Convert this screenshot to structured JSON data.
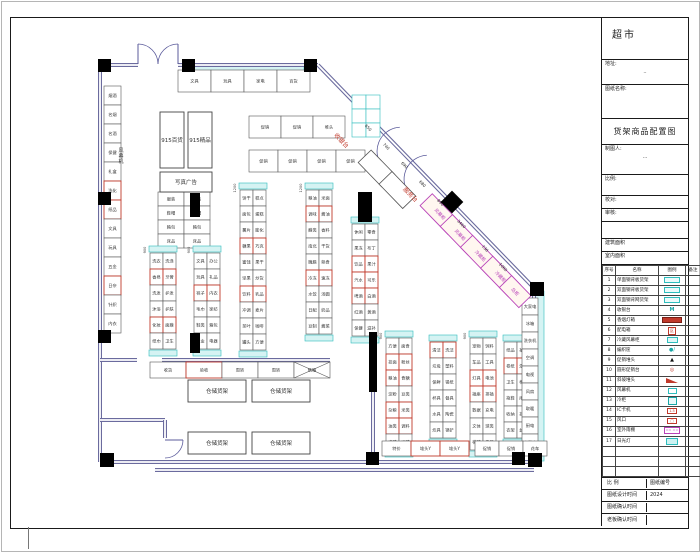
{
  "title_block": {
    "store_name": "超市",
    "address_label": "地址:",
    "address_value": "··",
    "drawing_name_label": "图纸名称:",
    "drawing_title": "货架商品配置图",
    "drafter_label": "制图人:",
    "drafter_value": "···",
    "scale_label": "比例:",
    "check_label": "校对:",
    "audit_label": "审核:",
    "area1_label": "建筑面积",
    "area2_label": "室内面积",
    "legend": {
      "headers": [
        "序号",
        "名称",
        "图例",
        "备注"
      ],
      "rows": [
        {
          "no": "1",
          "name": "单面钢背板货架",
          "sym": "cyanrect"
        },
        {
          "no": "2",
          "name": "双面钢背板货架",
          "sym": "cyanrect"
        },
        {
          "no": "3",
          "name": "双面钢背网货架",
          "sym": "cyanrect"
        },
        {
          "no": "4",
          "name": "收银台",
          "sym": "tealM",
          "text": "M"
        },
        {
          "no": "5",
          "name": "香烟灯箱",
          "sym": "redbar"
        },
        {
          "no": "6",
          "name": "配电箱",
          "sym": "redbox",
          "text": "区"
        },
        {
          "no": "7",
          "name": "冷藏风幕柜",
          "sym": "tealsm"
        },
        {
          "no": "8",
          "name": "编织筐",
          "sym": "dot",
          "text": "●/"
        },
        {
          "no": "9",
          "name": "促销堆头",
          "sym": "tri",
          "text": "▲"
        },
        {
          "no": "10",
          "name": "圆形促销台",
          "sym": "circ",
          "text": "◎"
        },
        {
          "no": "11",
          "name": "斜坡堆头",
          "sym": "wedge"
        },
        {
          "no": "12",
          "name": "风幕机",
          "sym": "cyansm"
        },
        {
          "no": "13",
          "name": "冷柜",
          "sym": "tealbox"
        },
        {
          "no": "14",
          "name": "IC卡机",
          "sym": "redsm",
          "text": "1.5"
        },
        {
          "no": "15",
          "name": "风口",
          "sym": "redsm",
          "text": "□"
        },
        {
          "no": "16",
          "name": "室外雨棚",
          "sym": "magbox",
          "text": "== =="
        },
        {
          "no": "17",
          "name": "日光灯",
          "sym": "cyanbox"
        },
        {
          "no": "",
          "name": "",
          "sym": ""
        },
        {
          "no": "",
          "name": "",
          "sym": ""
        },
        {
          "no": "",
          "name": "",
          "sym": ""
        }
      ]
    },
    "bottom_rows": [
      {
        "label": "比  例",
        "value_label": "图纸编号",
        "value": ""
      },
      {
        "label": "图纸设计时间",
        "value": "2024"
      },
      {
        "label": "图纸确认时间",
        "value": ""
      },
      {
        "label": "老板确认时间",
        "value": ""
      }
    ]
  },
  "plan": {
    "colors": {
      "wall": "#6b6b9e",
      "cyan": "#2fbdbd",
      "cyan_fill": "#d5f3f3",
      "red": "#c0392b",
      "magenta": "#b944b9",
      "ink": "#333333"
    },
    "walls": [
      {
        "pts": [
          [
            100,
            65
          ],
          [
            138,
            65
          ]
        ]
      },
      {
        "pts": [
          [
            178,
            65
          ],
          [
            318,
            65
          ]
        ]
      },
      {
        "pts": [
          [
            100,
            65
          ],
          [
            100,
            462
          ]
        ]
      },
      {
        "pts": [
          [
            318,
            65
          ],
          [
            534,
            288
          ]
        ]
      },
      {
        "pts": [
          [
            534,
            288
          ],
          [
            534,
            462
          ]
        ]
      },
      {
        "pts": [
          [
            100,
            462
          ],
          [
            534,
            462
          ]
        ]
      },
      {
        "pts": [
          [
            155,
            470
          ],
          [
            534,
            470
          ]
        ]
      },
      {
        "pts": [
          [
            100,
            360
          ],
          [
            137,
            360
          ]
        ]
      },
      {
        "pts": [
          [
            162,
            360
          ],
          [
            330,
            360
          ]
        ]
      },
      {
        "pts": [
          [
            373,
            330
          ],
          [
            373,
            462
          ]
        ]
      },
      {
        "pts": [
          [
            100,
            420
          ],
          [
            165,
            420
          ]
        ]
      },
      {
        "pts": [
          [
            165,
            420
          ],
          [
            165,
            438
          ]
        ]
      }
    ],
    "cyan_bands": [
      {
        "x": 184,
        "y": 66,
        "w": 120,
        "h": 8
      },
      {
        "x": 535,
        "y": 291,
        "w": 9,
        "h": 170
      }
    ],
    "columns": [
      {
        "x": 98,
        "y": 59,
        "s": 13
      },
      {
        "x": 182,
        "y": 59,
        "s": 13
      },
      {
        "x": 304,
        "y": 59,
        "s": 13
      },
      {
        "x": 98,
        "y": 192,
        "s": 13
      },
      {
        "x": 98,
        "y": 330,
        "s": 13
      },
      {
        "x": 100,
        "y": 453,
        "s": 14
      },
      {
        "x": 366,
        "y": 452,
        "s": 13
      },
      {
        "x": 512,
        "y": 452,
        "s": 13
      },
      {
        "x": 530,
        "y": 282,
        "s": 14
      },
      {
        "x": 528,
        "y": 453,
        "s": 14
      },
      {
        "x": 190,
        "y": 193,
        "s": 10,
        "h": 24
      },
      {
        "x": 190,
        "y": 333,
        "s": 10,
        "h": 20
      },
      {
        "x": 358,
        "y": 192,
        "s": 14,
        "h": 30
      },
      {
        "x": 369,
        "y": 332,
        "s": 8,
        "h": 60
      },
      {
        "x": 452,
        "y": 202,
        "s": 16,
        "shape": "diamond"
      }
    ],
    "doors": [
      {
        "hx": 138,
        "hy": 64,
        "r": 20,
        "dir": "up-right"
      },
      {
        "hx": 178,
        "hy": 64,
        "r": 20,
        "dir": "up-left"
      },
      {
        "hx": 401,
        "hy": 151,
        "r": 24,
        "dir": "diag"
      },
      {
        "hx": 428,
        "hy": 179,
        "r": 24,
        "dir": "diag"
      },
      {
        "hx": 165,
        "hy": 440,
        "r": 18,
        "dir": "right-down"
      }
    ],
    "gondolas": [
      {
        "x": 104,
        "y": 86,
        "cols": 1,
        "rows": 13,
        "cw": 17,
        "ch": 19,
        "caps": "none",
        "labels": [
          "烟酒",
          "名烟",
          "名酒",
          "保健",
          "礼盒",
          "洗化",
          "纸品",
          "文具",
          "玩具",
          "五金",
          "日杂",
          "针织",
          "内衣"
        ],
        "red": [
          5,
          6,
          10
        ]
      },
      {
        "x": 158,
        "y": 192,
        "cols": 2,
        "rows": 4,
        "cw": 26,
        "ch": 14,
        "caps": "none",
        "labels": [
          "服装",
          "服装",
          "鞋帽",
          "鞋帽",
          "箱包",
          "箱包",
          "床品",
          "床品"
        ],
        "red": []
      },
      {
        "x": 150,
        "y": 253,
        "cols": 2,
        "rows": 6,
        "cw": 13,
        "ch": 16,
        "caps": "tb",
        "labels": [
          "洗衣",
          "洗涤",
          "香皂",
          "牙膏",
          "洗发",
          "护发",
          "沐浴",
          "护肤",
          "化妆",
          "面膜",
          "纸巾",
          "卫生"
        ],
        "red": [
          2,
          3,
          8,
          9
        ]
      },
      {
        "x": 194,
        "y": 253,
        "cols": 2,
        "rows": 6,
        "cw": 13,
        "ch": 16,
        "caps": "tb",
        "labels": [
          "文具",
          "办公",
          "玩具",
          "礼品",
          "袜子",
          "内衣",
          "毛巾",
          "家纺",
          "鞋类",
          "箱包",
          "五金",
          "电器"
        ],
        "red": [
          4,
          5
        ]
      },
      {
        "x": 240,
        "y": 190,
        "cols": 2,
        "rows": 10,
        "cw": 13,
        "ch": 16,
        "caps": "tb",
        "labels": [
          "饼干",
          "糕点",
          "面包",
          "蛋糕",
          "薯片",
          "膨化",
          "糖果",
          "巧克",
          "蜜饯",
          "果干",
          "坚果",
          "炒货",
          "饮料",
          "乳品",
          "冲调",
          "麦片",
          "茶叶",
          "咖啡",
          "罐头",
          "方便"
        ],
        "red": [
          6,
          7,
          12,
          13
        ]
      },
      {
        "x": 306,
        "y": 190,
        "cols": 2,
        "rows": 9,
        "cw": 13,
        "ch": 16,
        "caps": "tb",
        "labels": [
          "粮油",
          "米面",
          "调味",
          "酱油",
          "醋类",
          "香料",
          "南北",
          "干货",
          "腌腊",
          "熟食",
          "冷冻",
          "速冻",
          "水饺",
          "汤圆",
          "日配",
          "奶品",
          "豆制",
          "酱菜"
        ],
        "red": [
          2,
          3,
          10,
          11
        ]
      },
      {
        "x": 352,
        "y": 224,
        "cols": 2,
        "rows": 7,
        "cw": 13,
        "ch": 16,
        "caps": "tb",
        "labels": [
          "休闲",
          "零食",
          "果冻",
          "布丁",
          "饮品",
          "果汁",
          "汽水",
          "可乐",
          "啤酒",
          "白酒",
          "红酒",
          "黄酒",
          "保健",
          "滋补"
        ],
        "red": [
          4,
          5,
          6,
          7,
          8,
          9
        ]
      },
      {
        "x": 386,
        "y": 338,
        "cols": 2,
        "rows": 7,
        "cw": 13,
        "ch": 16,
        "caps": "tb",
        "labels": [
          "方便",
          "面食",
          "挂面",
          "粉丝",
          "粮油",
          "食糖",
          "淀粉",
          "豆类",
          "杂粮",
          "米类",
          "油类",
          "调料",
          "鸡精",
          "味精"
        ],
        "red": [
          2,
          3,
          4,
          5,
          8,
          9,
          10,
          11
        ]
      },
      {
        "x": 430,
        "y": 342,
        "cols": 2,
        "rows": 6,
        "cw": 13,
        "ch": 16,
        "caps": "tb",
        "labels": [
          "清洁",
          "洗洁",
          "垃圾",
          "塑料",
          "保鲜",
          "锡纸",
          "杯具",
          "餐具",
          "水具",
          "陶瓷",
          "炊具",
          "锅铲"
        ],
        "red": [
          0,
          1
        ]
      },
      {
        "x": 470,
        "y": 338,
        "cols": 2,
        "rows": 7,
        "cw": 13,
        "ch": 16,
        "caps": "tb",
        "labels": [
          "宠物",
          "饲料",
          "车品",
          "工具",
          "灯具",
          "电池",
          "插座",
          "排插",
          "数据",
          "充电",
          "文体",
          "球类",
          "棋牌",
          "乐器"
        ],
        "red": [
          4,
          5,
          6,
          7
        ]
      },
      {
        "x": 504,
        "y": 342,
        "cols": 2,
        "rows": 6,
        "cw": 13,
        "ch": 16,
        "caps": "tb",
        "labels": [
          "纸品",
          "抽纸",
          "卷纸",
          "湿巾",
          "卫生",
          "棉柔",
          "拖鞋",
          "雨具",
          "收纳",
          "挂钩",
          "衣架",
          "盆桶"
        ],
        "red": [
          2,
          3
        ]
      },
      {
        "x": 522,
        "y": 298,
        "cols": 1,
        "rows": 9,
        "cw": 16,
        "ch": 17,
        "caps": "none",
        "labels": [
          "大家电",
          "冰箱",
          "洗衣机",
          "空调",
          "电视",
          "风扇",
          "取暖",
          "厨电",
          "小家电"
        ],
        "red": []
      },
      {
        "x": 178,
        "y": 70,
        "cols": 4,
        "rows": 1,
        "cw": 33,
        "ch": 22,
        "caps": "none",
        "labels": [
          "文具",
          "玩具",
          "家电",
          "百货"
        ],
        "red": []
      },
      {
        "x": 249,
        "y": 116,
        "cols": 3,
        "rows": 1,
        "cw": 32,
        "ch": 22,
        "caps": "none",
        "labels": [
          "促销",
          "促销",
          "堆头"
        ],
        "red": []
      },
      {
        "x": 249,
        "y": 150,
        "cols": 4,
        "rows": 1,
        "cw": 29,
        "ch": 22,
        "caps": "none",
        "labels": [
          "促销",
          "促销",
          "促销",
          "促销"
        ],
        "red": []
      },
      {
        "x": 352,
        "y": 95,
        "cols": 2,
        "rows": 3,
        "cw": 14,
        "ch": 14,
        "caps": "none",
        "labels": [
          "",
          "",
          "",
          "",
          "",
          ""
        ],
        "red": [],
        "cyan_stroke": true
      },
      {
        "x": 150,
        "y": 362,
        "cols": 5,
        "rows": 1,
        "cw": 36,
        "ch": 16,
        "caps": "none",
        "labels": [
          "收货",
          "验收",
          "周转",
          "周转",
          "纸箱"
        ],
        "red": [
          1
        ],
        "cross": [
          4
        ]
      },
      {
        "x": 382,
        "y": 441,
        "cols": 3,
        "rows": 1,
        "cw": 29,
        "ch": 15,
        "caps": "none",
        "labels": [
          "特价",
          "堆头Y",
          "堆头Y"
        ],
        "red": [
          1,
          2
        ]
      },
      {
        "x": 475,
        "y": 441,
        "cols": 3,
        "rows": 1,
        "cw": 24,
        "ch": 15,
        "caps": "none",
        "labels": [
          "促销",
          "促销",
          "花车"
        ],
        "red": []
      }
    ],
    "big_rects": [
      {
        "x": 160,
        "y": 112,
        "w": 24,
        "h": 56,
        "label": "915百货"
      },
      {
        "x": 188,
        "y": 112,
        "w": 24,
        "h": 56,
        "label": "915精品"
      },
      {
        "x": 160,
        "y": 172,
        "w": 52,
        "h": 20,
        "label": "写真广告"
      },
      {
        "x": 188,
        "y": 380,
        "w": 58,
        "h": 22,
        "label": "仓储货架"
      },
      {
        "x": 252,
        "y": 380,
        "w": 58,
        "h": 22,
        "label": "仓储货架"
      },
      {
        "x": 188,
        "y": 432,
        "w": 58,
        "h": 22,
        "label": "仓储货架"
      },
      {
        "x": 252,
        "y": 432,
        "w": 58,
        "h": 22,
        "label": "仓储货架"
      }
    ],
    "diagonal": {
      "x1": 318,
      "y1": 65,
      "x2": 534,
      "y2": 288,
      "fixtures": [
        {
          "d": 192,
          "off": 16,
          "w": 40,
          "h": 17,
          "label": "风幕柜"
        },
        {
          "d": 221,
          "off": 16,
          "w": 40,
          "h": 17,
          "label": "风幕柜"
        },
        {
          "d": 250,
          "off": 16,
          "w": 40,
          "h": 17,
          "label": "冷藏柜"
        },
        {
          "d": 279,
          "off": 16,
          "w": 40,
          "h": 17,
          "label": "冷藏柜"
        },
        {
          "d": 300,
          "off": 16,
          "w": 28,
          "h": 17,
          "label": "岛柜"
        }
      ],
      "white_fixtures": [
        {
          "d": 115,
          "off": 30,
          "w": 34,
          "h": 18
        },
        {
          "d": 145,
          "off": 30,
          "w": 34,
          "h": 18
        }
      ],
      "dims": [
        {
          "d": 80,
          "v": "650"
        },
        {
          "d": 106,
          "v": "740"
        },
        {
          "d": 132,
          "v": "690"
        },
        {
          "d": 158,
          "v": "680"
        },
        {
          "d": 184,
          "v": "890"
        },
        {
          "d": 214,
          "v": "3460"
        },
        {
          "d": 248,
          "v": "730"
        },
        {
          "d": 274,
          "v": "1060"
        }
      ]
    },
    "texts": [
      {
        "x": 340,
        "y": 142,
        "t": "收银台",
        "color": "#c0392b",
        "size": 6,
        "rot": 46
      },
      {
        "x": 409,
        "y": 196,
        "t": "服务台",
        "color": "#c0392b",
        "size": 6,
        "rot": 46
      },
      {
        "x": 121,
        "y": 152,
        "t": "风幕机",
        "color": "#333333",
        "size": 5,
        "vertical": true
      },
      {
        "x": 146,
        "y": 250,
        "t": "900",
        "color": "#444444",
        "size": 3.5,
        "rot": -90
      },
      {
        "x": 190,
        "y": 250,
        "t": "900",
        "color": "#444444",
        "size": 3.5,
        "rot": -90
      },
      {
        "x": 236,
        "y": 188,
        "t": "1200",
        "color": "#444444",
        "size": 3.5,
        "rot": -90
      },
      {
        "x": 302,
        "y": 188,
        "t": "1200",
        "color": "#444444",
        "size": 3.5,
        "rot": -90
      },
      {
        "x": 382,
        "y": 336,
        "t": "900",
        "color": "#444444",
        "size": 3.5,
        "rot": -90
      },
      {
        "x": 466,
        "y": 336,
        "t": "900",
        "color": "#444444",
        "size": 3.5,
        "rot": -90
      }
    ]
  }
}
